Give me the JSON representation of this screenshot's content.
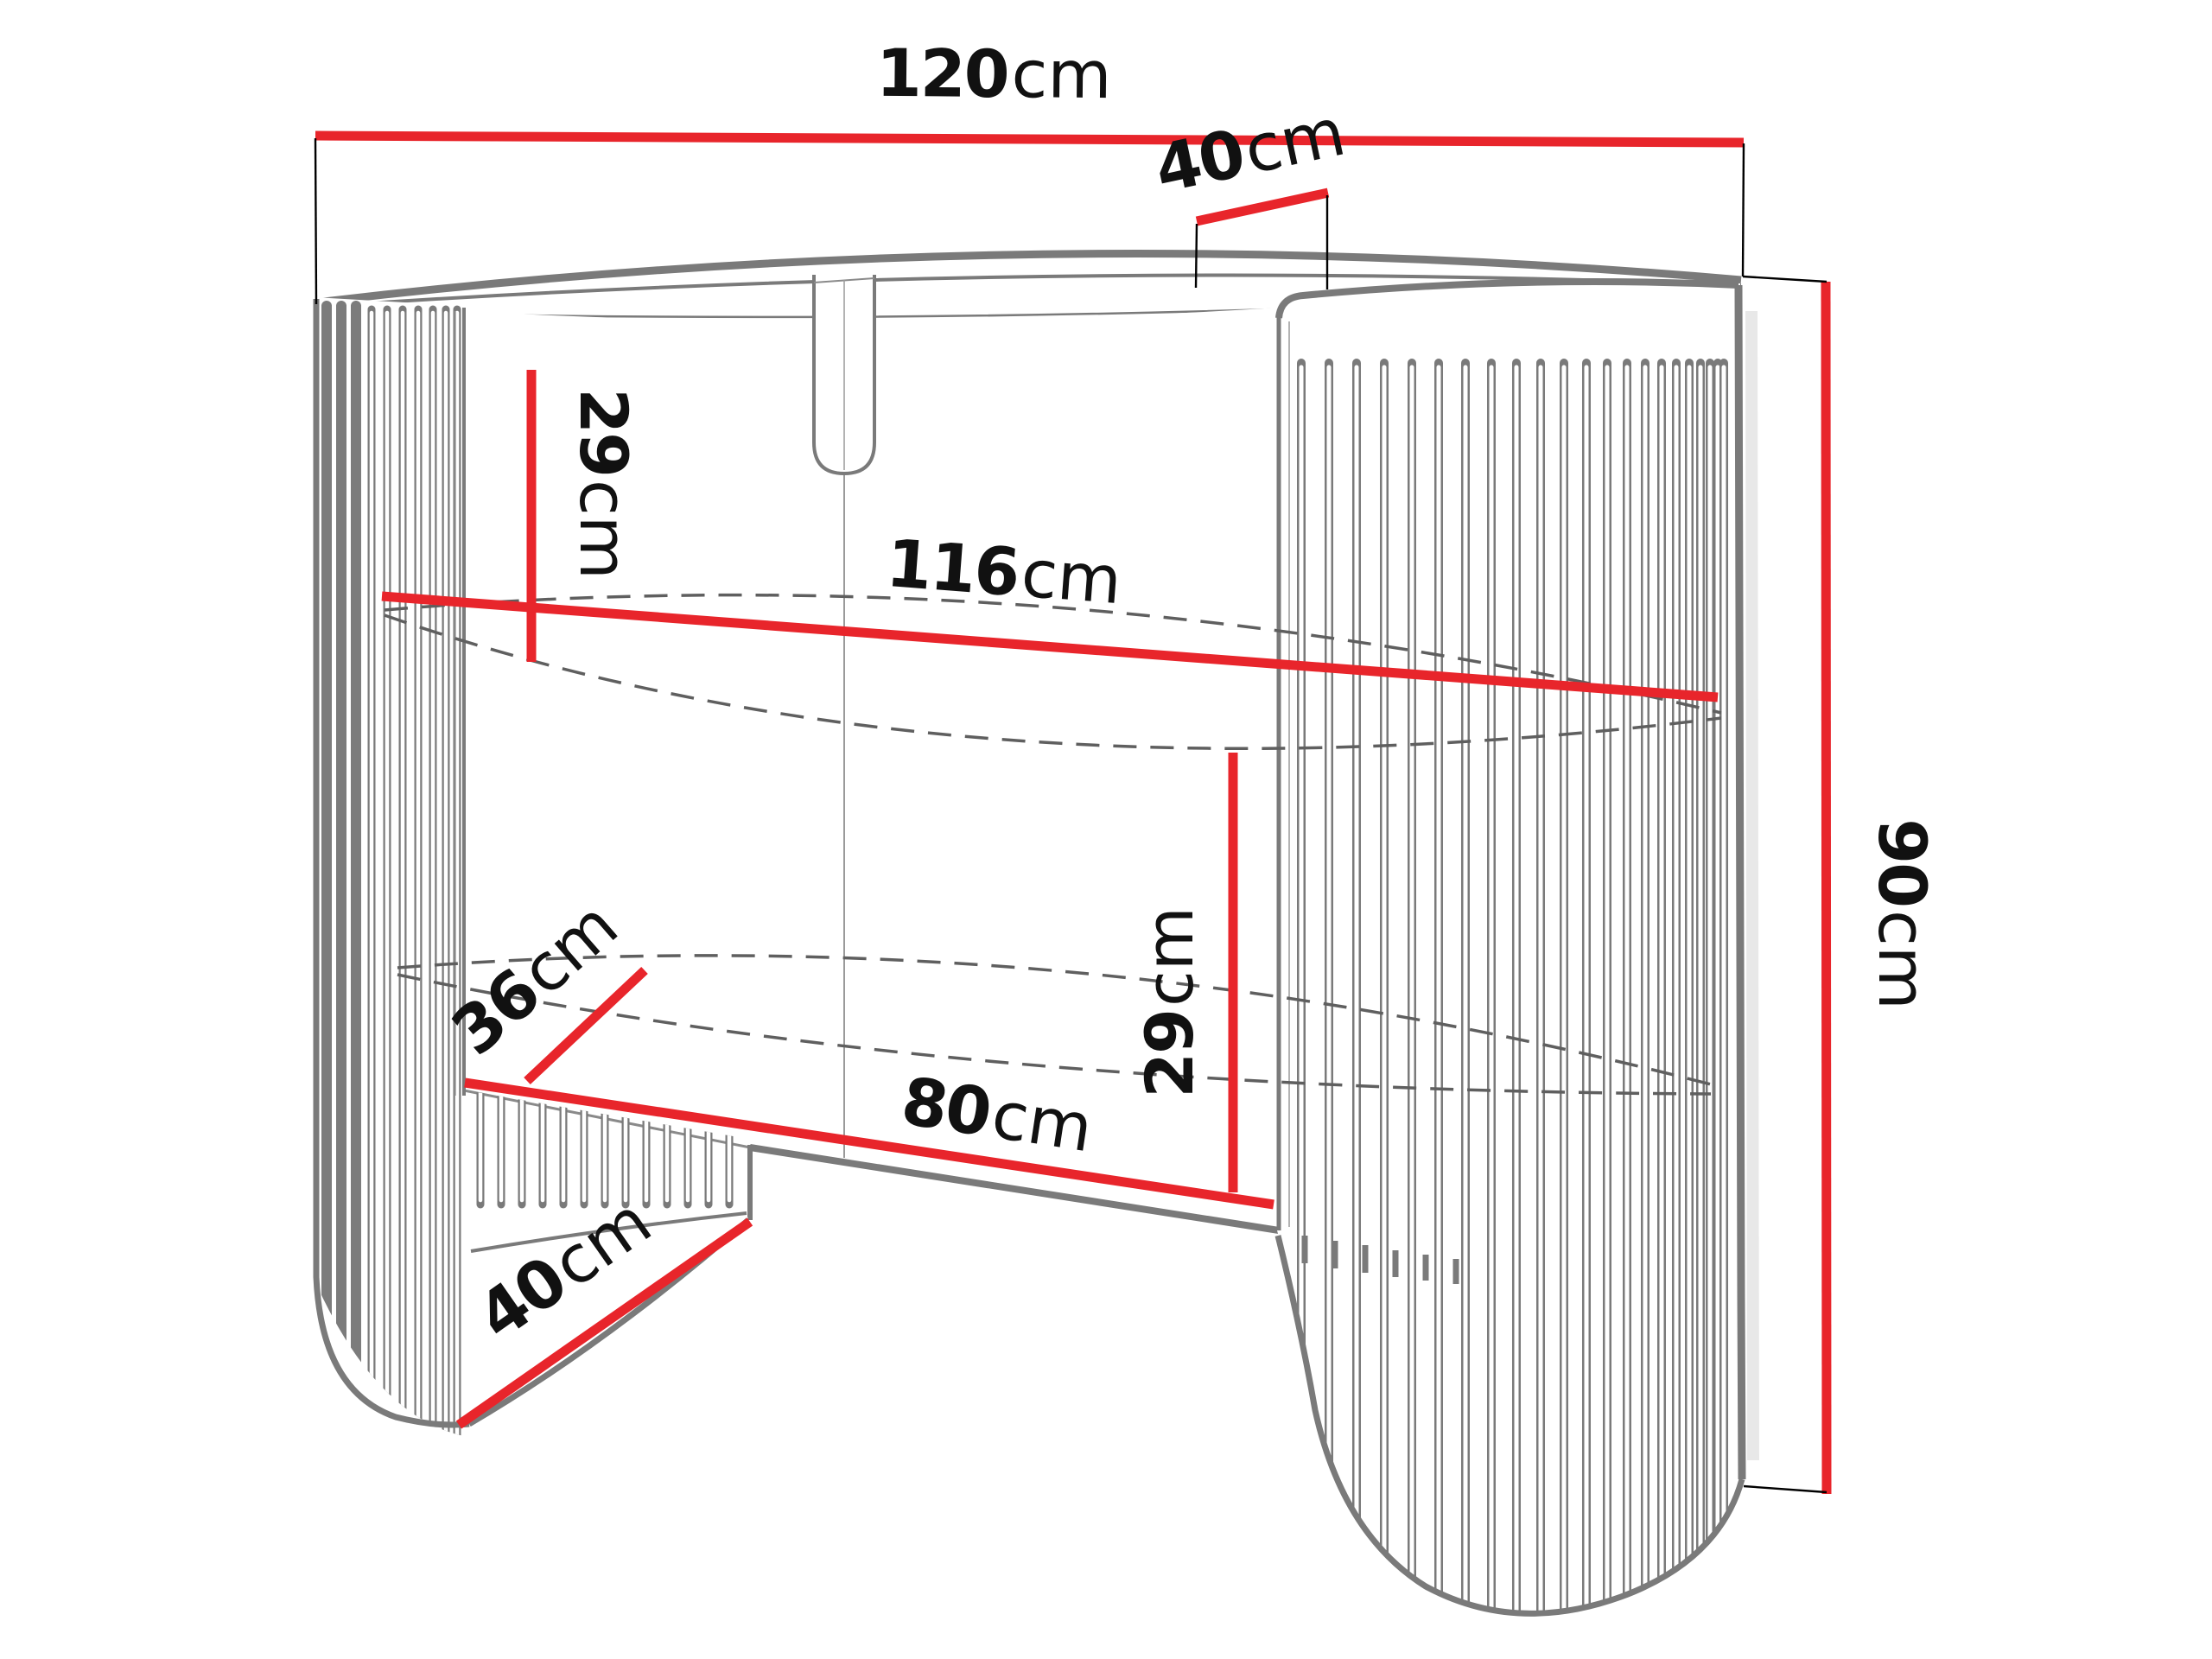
{
  "dimensions": {
    "top_width": {
      "value": "120",
      "unit": "cm"
    },
    "top_depth": {
      "value": "40",
      "unit": "cm"
    },
    "top_to_middle_shelf": {
      "value": "29",
      "unit": "cm"
    },
    "inner_width": {
      "value": "116",
      "unit": "cm"
    },
    "overall_height": {
      "value": "90",
      "unit": "cm"
    },
    "shelf_depth": {
      "value": "36",
      "unit": "cm"
    },
    "middle_shelf_to_bottom": {
      "value": "29",
      "unit": "cm"
    },
    "opening_width": {
      "value": "80",
      "unit": "cm"
    },
    "base_depth": {
      "value": "40",
      "unit": "cm"
    }
  },
  "colors": {
    "dimension_line": "#e8252b",
    "drawing_outline": "#7a7a7a",
    "label_text": "#111111",
    "background": "#ffffff"
  }
}
